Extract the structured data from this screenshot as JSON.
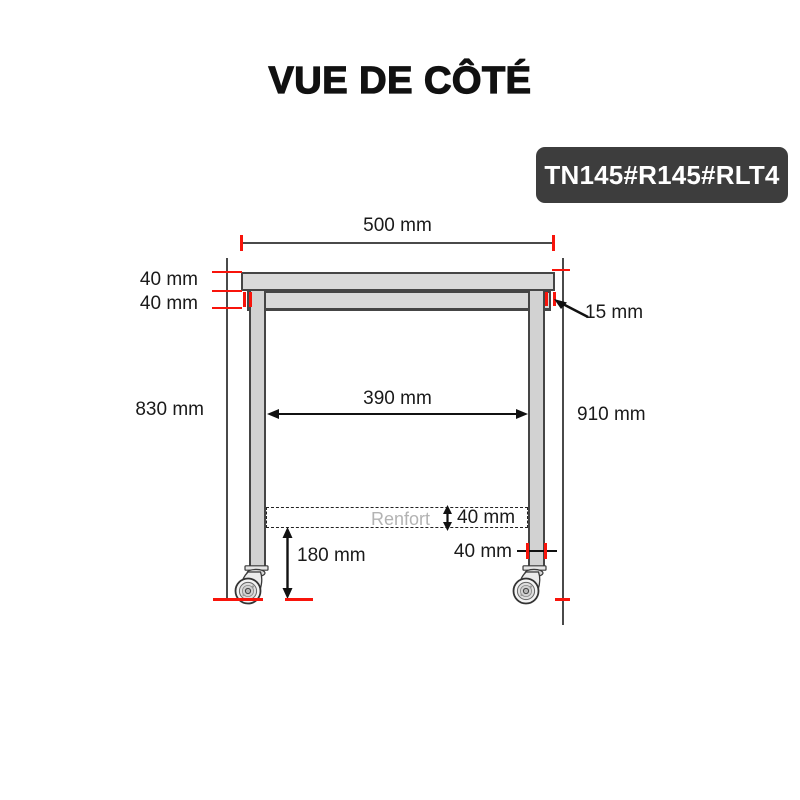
{
  "title": "VUE DE CÔTÉ",
  "badge": {
    "label": "TN145#R145#RLT4"
  },
  "colors": {
    "accent_red": "#f8140b",
    "line_dark": "#454545",
    "fill_gray": "#d9d9d9",
    "badge_bg": "#3d3d3d",
    "badge_text": "#ffffff",
    "renfort_gray": "#b3b3b3"
  },
  "diagram": {
    "type": "technical-side-view",
    "subject": "table with casters",
    "unit": "mm",
    "labels": {
      "top_width": "500 mm",
      "top_thickness": "40 mm",
      "frame_height": "40 mm",
      "leg_inset": "15 mm",
      "left_height": "830 mm",
      "inner_width": "390 mm",
      "right_height": "910 mm",
      "reinforcement": "Renfort",
      "reinforcement_height": "40 mm",
      "leg_width": "40 mm",
      "caster_clearance": "180 mm"
    },
    "values_mm": {
      "top_width": 500,
      "top_thickness": 40,
      "frame_height": 40,
      "leg_inset": 15,
      "left_height": 830,
      "inner_width": 390,
      "right_height": 910,
      "reinforcement_height": 40,
      "leg_width": 40,
      "caster_clearance": 180
    }
  }
}
